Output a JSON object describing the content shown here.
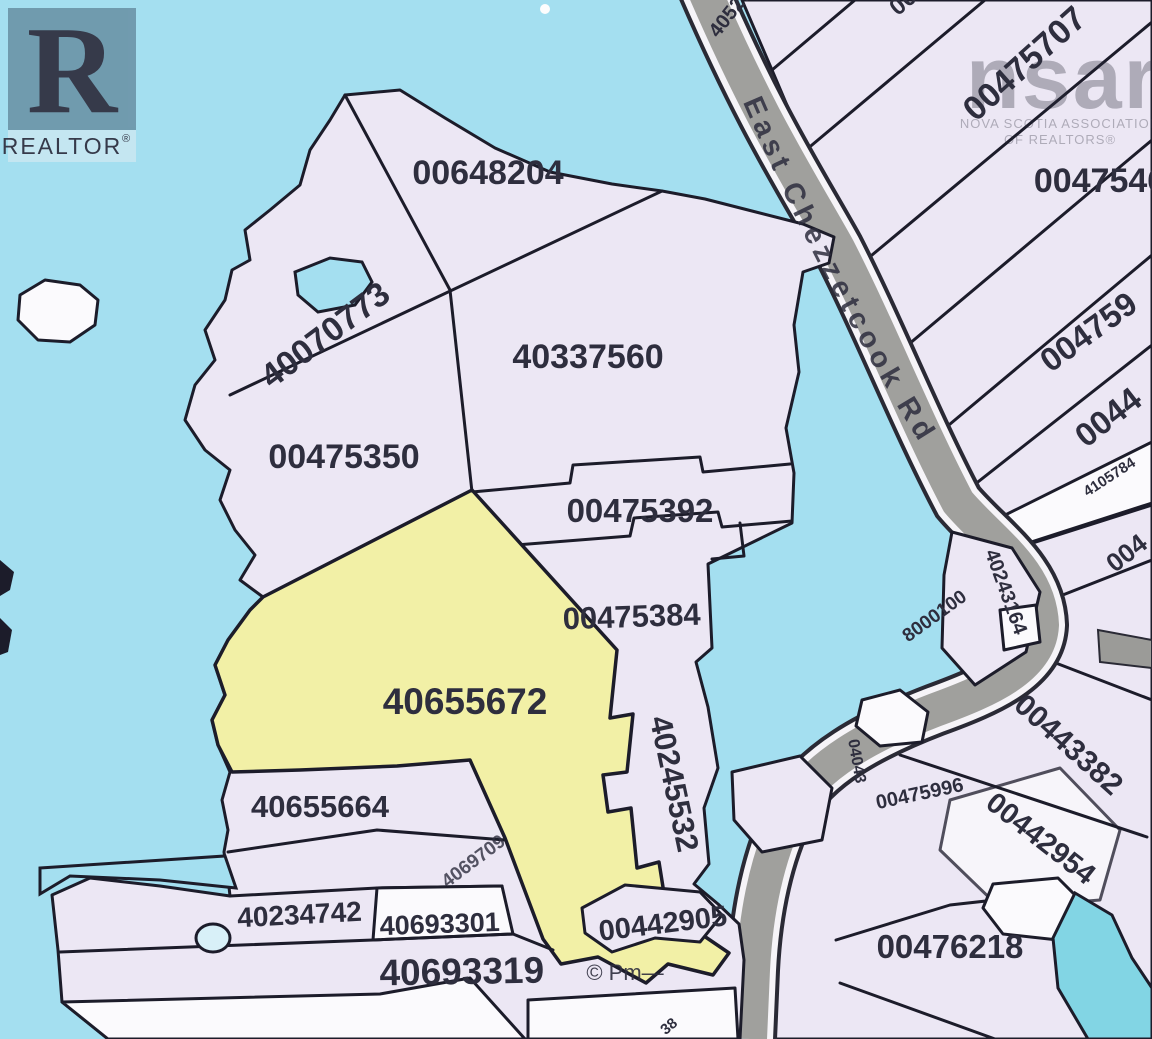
{
  "map": {
    "road_name": "East Chezzetcook Rd",
    "highlighted_parcel": "40655672",
    "water_color": "#a4dff0",
    "parcel_color": "#ece7f4",
    "highlight_color": "#f2f0a6",
    "road_color": "#a0a09d",
    "pond_color": "#82d5e4",
    "border_color": "#1c1c2a"
  },
  "labels": {
    "p00648204": "00648204",
    "p40070773": "40070773",
    "p40337560": "40337560",
    "p00475350": "00475350",
    "p00475392": "00475392",
    "p00475384": "00475384",
    "p40655672": "40655672",
    "p40245532": "40245532",
    "p40655664": "40655664",
    "p40234742": "40234742",
    "p4069709": "4069709",
    "p40693301": "40693301",
    "p40693319": "40693319",
    "p00442905": "00442905",
    "p00476218": "00476218",
    "p00443382": "00443382",
    "p00442954": "00442954",
    "p00475996": "00475996",
    "p00475707": "00475707",
    "p0047546": "0047546",
    "p004759": "004759",
    "p0044": "0044",
    "p4105784": "4105784",
    "p004": "004",
    "p40243164": "40243164",
    "p8000100": "8000100",
    "p04043": "04043",
    "p4052704": "4052704",
    "p00top": "00",
    "p38": "38"
  },
  "branding": {
    "realtor_r": "R",
    "realtor_text": "REALTOR",
    "realtor_reg": "®",
    "nsar": "nsar",
    "nsar_line1": "NOVA SCOTIA ASSOCIATION",
    "nsar_line2": "OF REALTORS®",
    "copyright": "© Pm—"
  }
}
